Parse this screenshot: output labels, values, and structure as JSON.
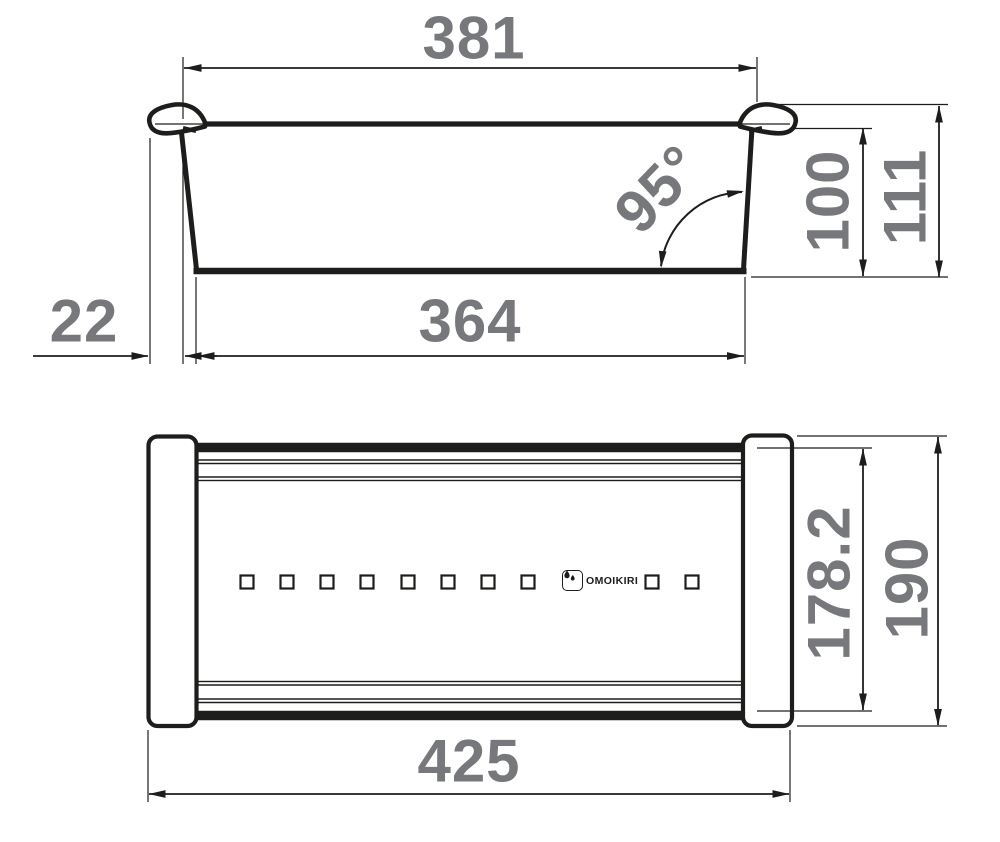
{
  "brand": "OMOIKIRI",
  "side_view": {
    "rim_width": "381",
    "base_width": "364",
    "lip_overhang": "22",
    "wall_angle": "95°",
    "bowl_depth": "100",
    "overall_height": "111"
  },
  "plan_view": {
    "overall_length": "425",
    "body_width": "178.2",
    "overall_width": "190"
  },
  "colors": {
    "line": "#1d1d1b",
    "label": "#77787b",
    "background": "#ffffff"
  }
}
